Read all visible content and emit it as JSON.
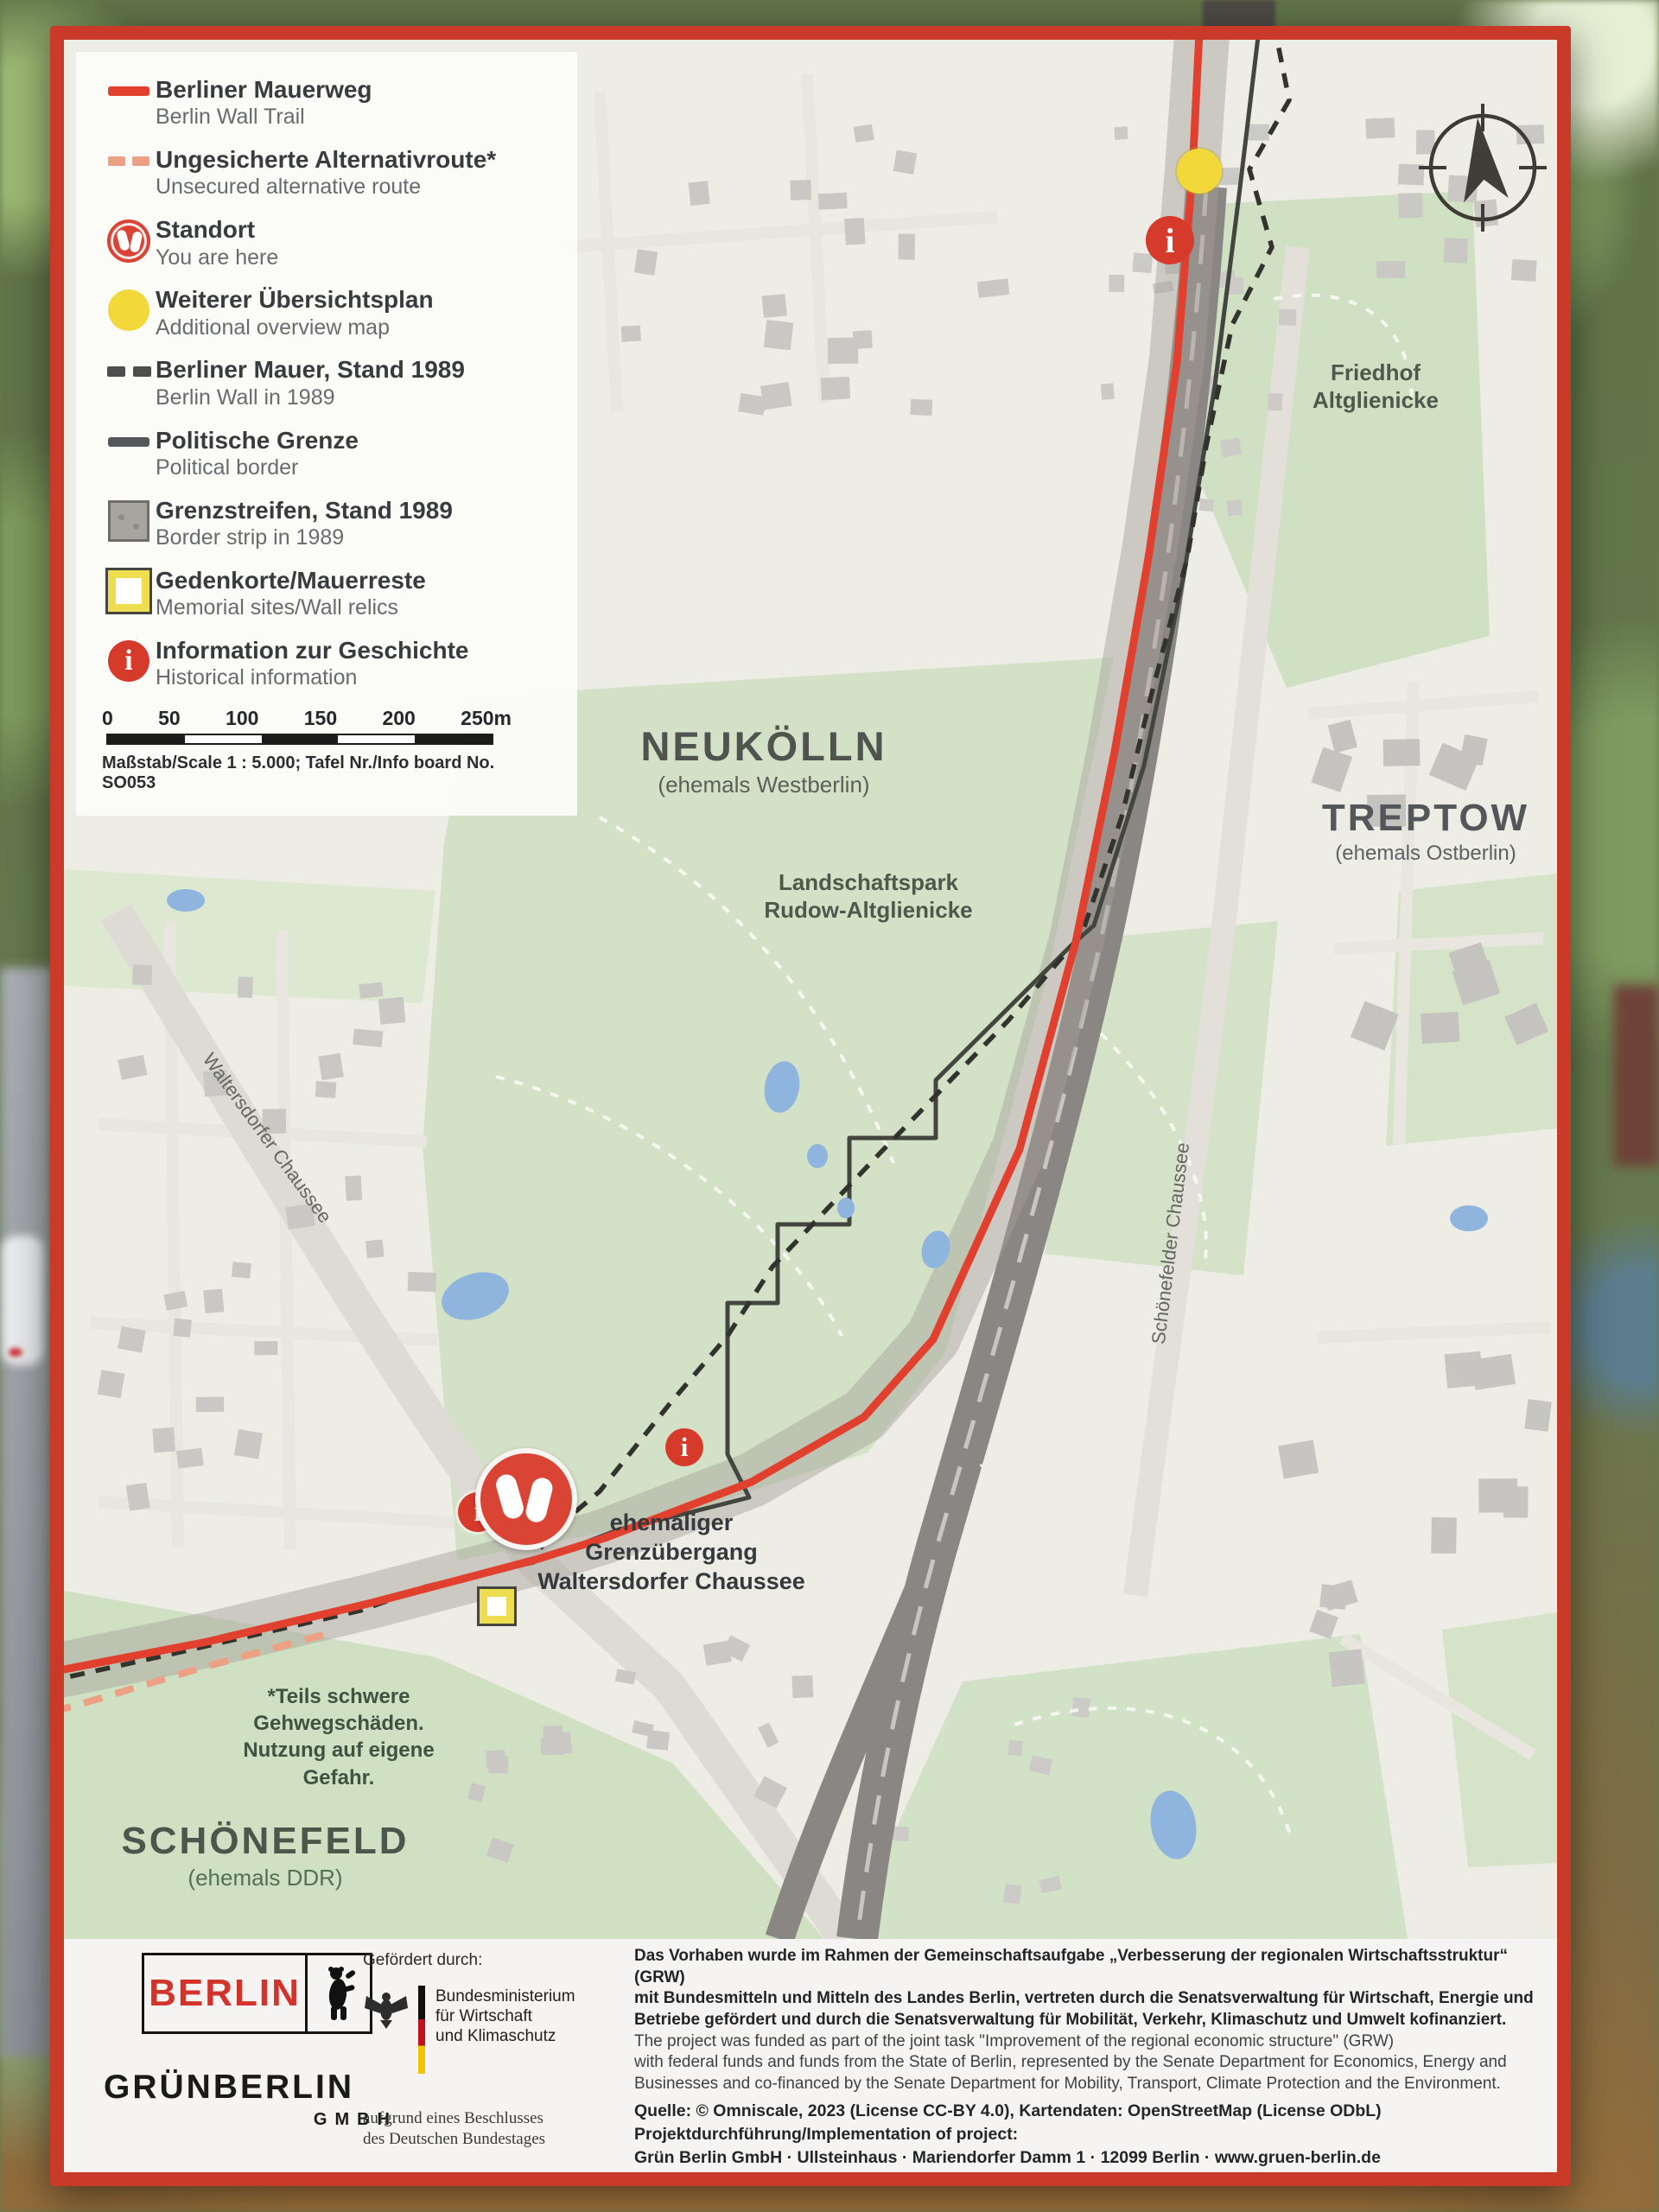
{
  "legend": {
    "items": [
      {
        "de": "Berliner Mauerweg",
        "en": "Berlin Wall Trail",
        "icon": "red-line"
      },
      {
        "de": "Ungesicherte Alternativroute*",
        "en": "Unsecured alternative route",
        "icon": "red-dashed-line"
      },
      {
        "de": "Standort",
        "en": "You are here",
        "icon": "footprints-badge"
      },
      {
        "de": "Weiterer Übersichtsplan",
        "en": "Additional overview map",
        "icon": "yellow-dot"
      },
      {
        "de": "Berliner Mauer, Stand 1989",
        "en": "Berlin Wall in 1989",
        "icon": "black-dashed-line"
      },
      {
        "de": "Politische Grenze",
        "en": "Political border",
        "icon": "dark-line"
      },
      {
        "de": "Grenzstreifen, Stand 1989",
        "en": "Border strip in 1989",
        "icon": "gray-square"
      },
      {
        "de": "Gedenkorte/Mauerreste",
        "en": "Memorial sites/Wall relics",
        "icon": "yellow-square"
      },
      {
        "de": "Information zur Geschichte",
        "en": "Historical information",
        "icon": "info-badge"
      }
    ],
    "scale": {
      "ticks": [
        "0",
        "50",
        "100",
        "150",
        "200",
        "250m"
      ],
      "caption": "Maßstab/Scale 1 : 5.000; Tafel Nr./Info board No. SO053"
    }
  },
  "map": {
    "labels": {
      "neukoelln": {
        "name": "NEUKÖLLN",
        "sub": "(ehemals Westberlin)"
      },
      "treptow": {
        "name": "TREPTOW",
        "sub": "(ehemals Ostberlin)"
      },
      "schoenefeld": {
        "name": "SCHÖNEFELD",
        "sub": "(ehemals DDR)"
      },
      "friedhof": "Friedhof\nAltglienicke",
      "landschaftspark": "Landschaftspark\nRudow-Altglienicke",
      "border_crossing": "ehemaliger\nGrenzübergang\nWaltersdorfer Chaussee",
      "warning_note": "*Teils schwere\nGehwegschäden.\nNutzung auf eigene\nGefahr.",
      "road_waltersdorfer": "Waltersdorfer Chaussee",
      "road_schoenefelder": "Schönefelder Chaussee",
      "highway": "A113",
      "info_glyph": "i"
    },
    "colors": {
      "trail_red": "#e2402e",
      "alt_route": "#eda184",
      "wall_dashed": "#33332e",
      "political_border": "#43463f",
      "border_strip": "#a59f98",
      "marker_yellow": "#f2d838",
      "water_blue": "#8fb5de",
      "park_green": "#d3e2c6",
      "frame_red": "#c93b28"
    }
  },
  "footer": {
    "berlin_logo": "BERLIN",
    "gruen_berlin": "GRÜNBERLIN",
    "gruen_berlin_sub": "GMBH",
    "funded_by": "Gefördert durch:",
    "ministry": "Bundesministerium\nfür Wirtschaft\nund Klimaschutz",
    "bundestag_note": "aufgrund eines Beschlusses\ndes Deutschen Bundestages",
    "text_de": "Das Vorhaben wurde im Rahmen der Gemeinschaftsaufgabe „Verbesserung der regionalen Wirtschaftsstruktur“ (GRW)\nmit Bundesmitteln und Mitteln des Landes Berlin, vertreten durch die Senatsverwaltung für Wirtschaft, Energie und\nBetriebe gefördert und durch die Senatsverwaltung für Mobilität, Verkehr, Klimaschutz und Umwelt kofinanziert.",
    "text_en": "The project was funded as part of the joint task \"Improvement of the regional economic structure\" (GRW)\nwith federal funds and funds from the State of Berlin, represented by the Senate Department for Economics, Energy and\nBusinesses and co-financed by the Senate Department for Mobility, Transport, Climate Protection and the Environment.",
    "source_line": "Quelle: © Omniscale, 2023 (License CC-BY 4.0), Kartendaten: OpenStreetMap (License ODbL)",
    "implementation_label": "Projektdurchführung/Implementation of project:",
    "address_line": "Grün Berlin GmbH · Ullsteinhaus · Mariendorfer Damm 1 · 12099 Berlin · www.gruen-berlin.de"
  }
}
